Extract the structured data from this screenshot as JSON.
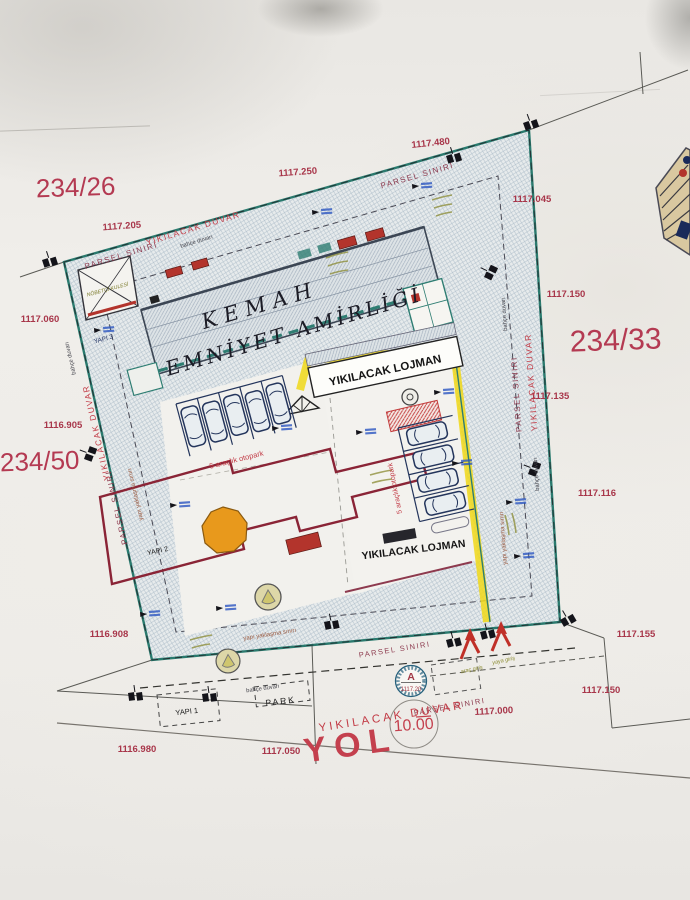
{
  "plan": {
    "building": {
      "title_line1": "KEMAH",
      "title_line2": "EMNİYET AMİRLİĞİ"
    },
    "parcel_numbers": {
      "northwest": "234/26",
      "east": "234/33",
      "west": "234/50"
    },
    "road": {
      "name": "YOL",
      "width": "10.00"
    },
    "benchmark": {
      "letter": "A",
      "elevation": "1117.20"
    },
    "boundary_labels": {
      "parsel_siniri": "PARSEL SINIRI",
      "yikilacak_duvar": "YIKILACAK DUVAR",
      "bahce_duvari": "bahçe duvarı",
      "yapi_yaklasma_siniri": "yapı yaklaşma sınırı"
    },
    "features": {
      "lojman": "YIKILACAK LOJMAN",
      "otopark": "5 araçlık otopark",
      "yapi1": "YAPI 1",
      "yapi2": "YAPI 2",
      "yapi3": "YAPI 3",
      "park": "PARK",
      "guard_tower": "NÖBETÇİ KULESİ",
      "vehicle_entrance": "araç giriş",
      "pedestrian_entrance": "yaya giriş"
    },
    "elevations": {
      "n1": "1117.205",
      "n2": "1117.250",
      "n3": "1117.480",
      "ne": "1117.045",
      "e1": "1117.150",
      "e2": "1117.135",
      "e3": "1117.116",
      "e4": "1117.155",
      "e5": "1117.150",
      "w1": "1117.060",
      "w2": "1116.905",
      "w3": "1116.908",
      "s1": "1116.980",
      "s2": "1117.050",
      "s3": "1117.000"
    },
    "colors": {
      "elevation_red": "#a8364a",
      "label_red": "#c23b46",
      "boundary_maroon": "#8d3a4e",
      "hatch_blue": "#a9b9c6",
      "path_yellow": "#f0d818",
      "accent_orange": "#e8991c"
    }
  }
}
